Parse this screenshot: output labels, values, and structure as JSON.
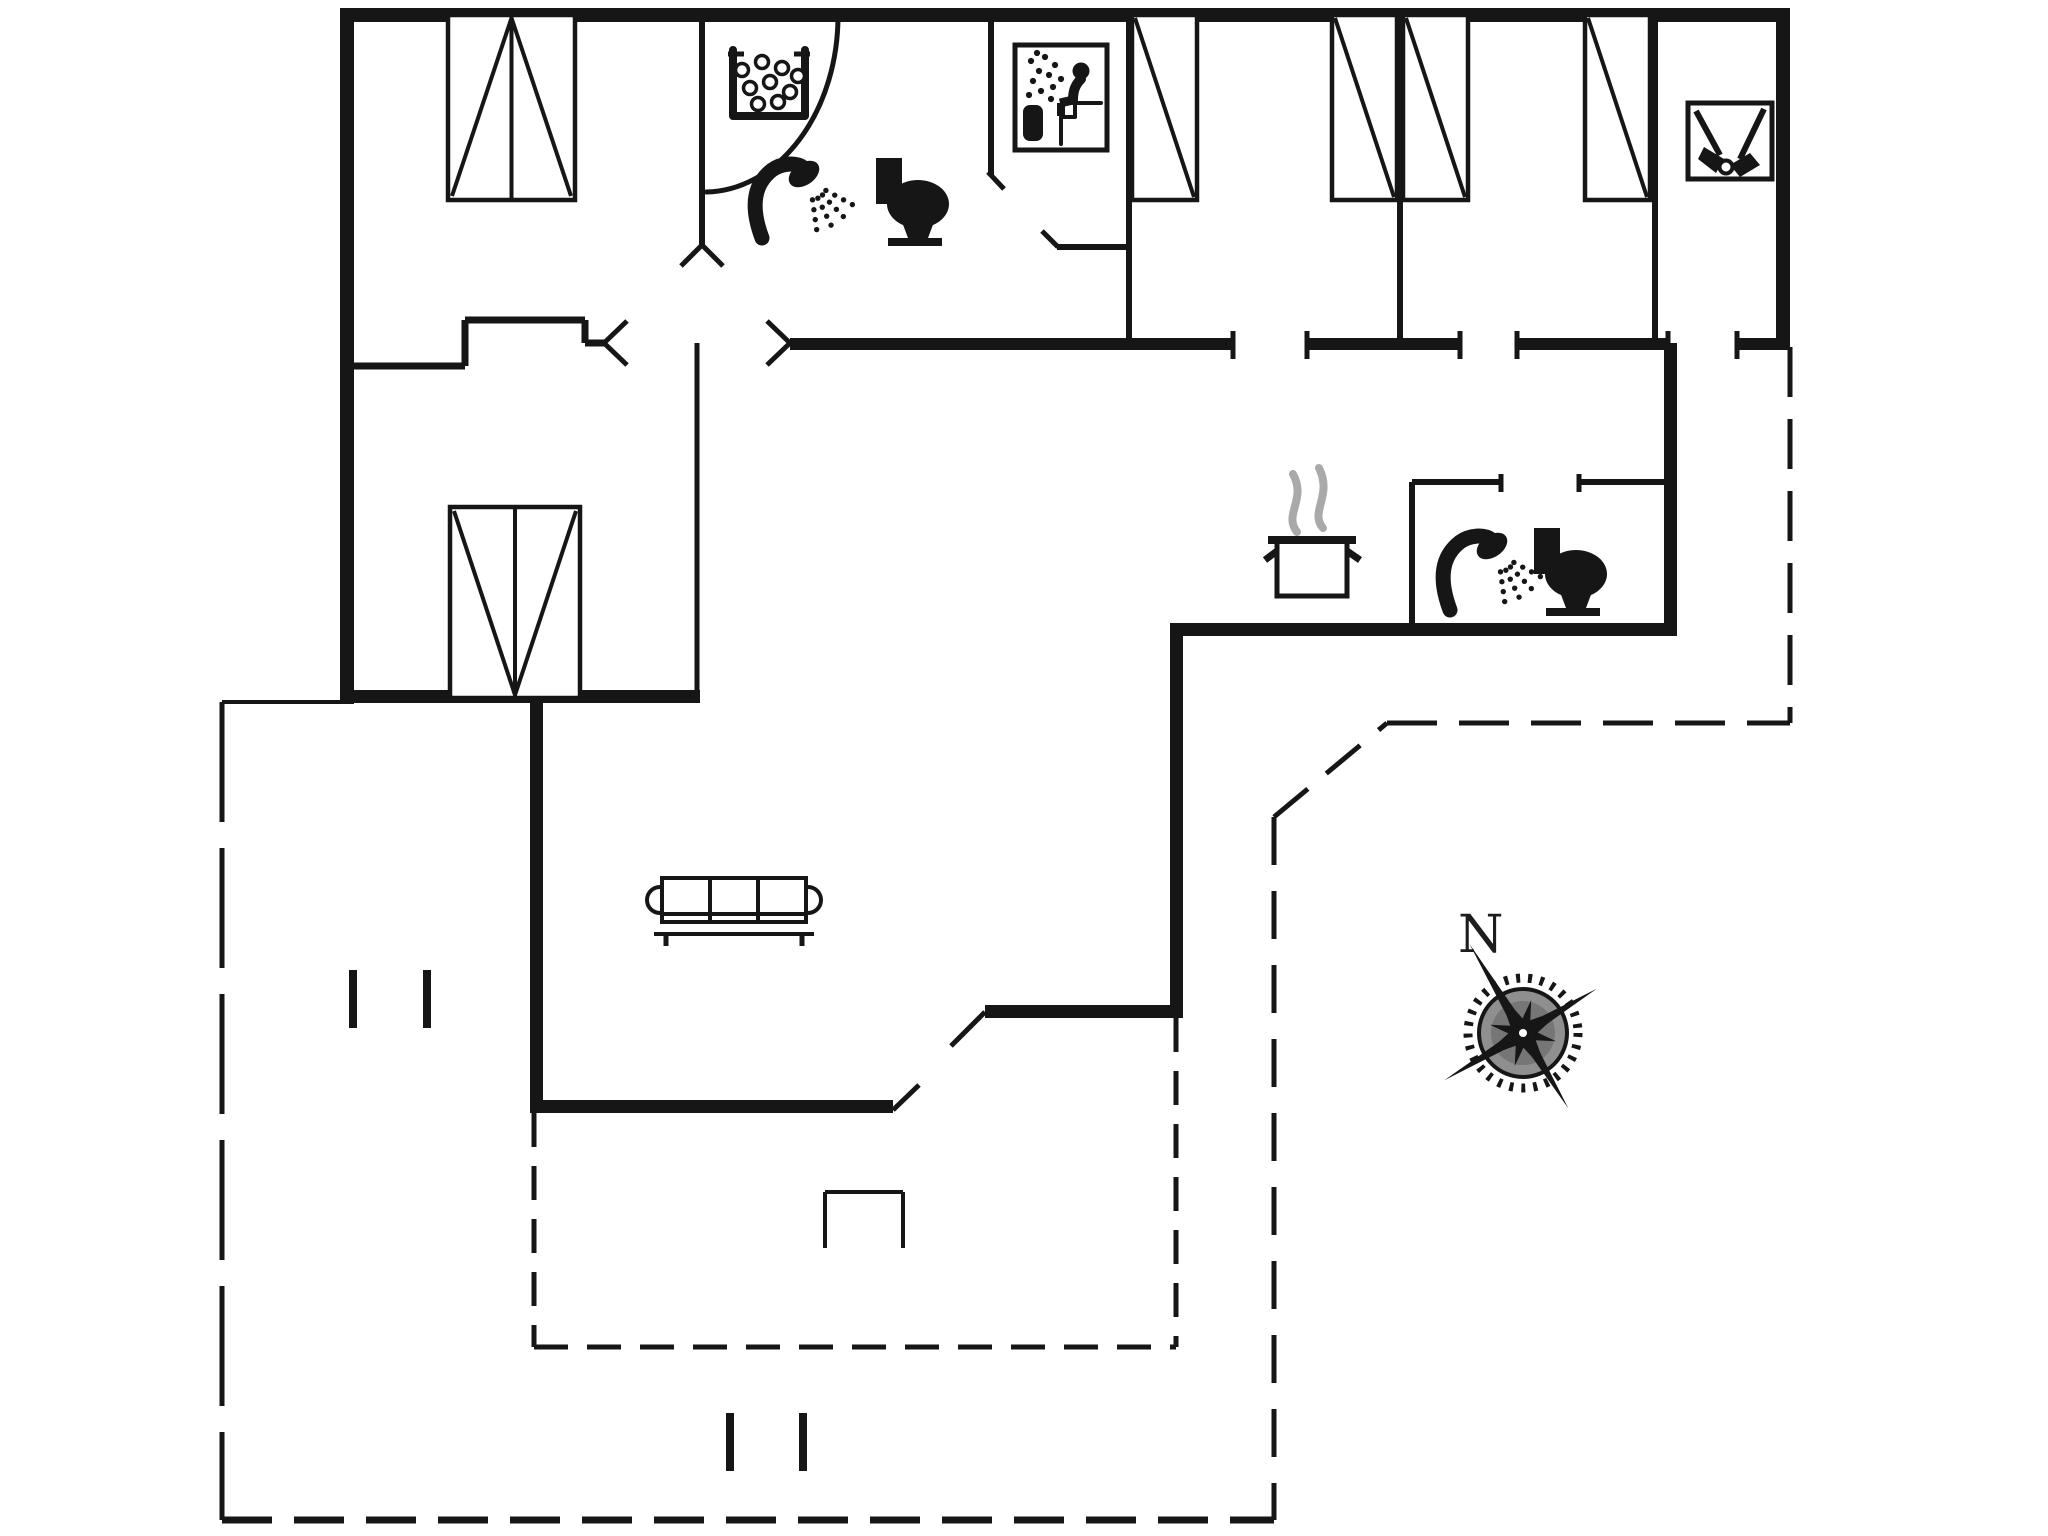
{
  "meta": {
    "type": "floorplan",
    "bg_color": "#ffffff",
    "ink_color": "#161616",
    "steam_color": "#a9a9a9",
    "compass_disc_color": "#8f8f8f",
    "compass_inner_color": "#767676"
  },
  "compass": {
    "label": "N",
    "cx": 1523,
    "cy": 1033,
    "gear_r": 55,
    "disc_r": 44,
    "inner_r": 32,
    "rot": -31,
    "spike_len": [
      104,
      86,
      88,
      92
    ],
    "star_len": 42,
    "diag_star_len": 34,
    "label_x": 1458,
    "label_y": 952
  },
  "walls_thick": [
    [
      340,
      8,
      1450,
      14,
      "exterior-wall-north"
    ],
    [
      340,
      8,
      14,
      696,
      "exterior-wall-west"
    ],
    [
      1776,
      8,
      14,
      342,
      "exterior-wall-east"
    ],
    [
      340,
      690,
      360,
      13,
      "alcove-south-wall"
    ],
    [
      530,
      701,
      13,
      412,
      "living-room-west-wall"
    ],
    [
      530,
      1100,
      363,
      13,
      "living-room-south-wall"
    ],
    [
      985,
      1005,
      198,
      13,
      "kitchen-south-wall"
    ],
    [
      1170,
      628,
      13,
      390,
      "kitchen-east-wall"
    ],
    [
      1170,
      623,
      507,
      13,
      "kitchen-bathroom-south-wall"
    ],
    [
      1664,
      343,
      13,
      293,
      "bathroom2-east-wall"
    ],
    [
      790,
      338,
      443,
      12,
      "corridor-wall-segment"
    ],
    [
      1307,
      338,
      153,
      12,
      "corridor-wall-segment"
    ],
    [
      1517,
      338,
      151,
      12,
      "corridor-wall-segment"
    ],
    [
      1737,
      338,
      53,
      12,
      "corridor-wall-segment"
    ]
  ],
  "walls_thin": [
    [
      702,
      15,
      702,
      245,
      6,
      "bedroom1-bathroom-partition"
    ],
    [
      991,
      15,
      991,
      175,
      6,
      "sauna-west-wall"
    ],
    [
      1057,
      247,
      1129,
      247,
      6,
      "sauna-south-wall"
    ],
    [
      1129,
      15,
      1129,
      343,
      6,
      "sauna-east-wall"
    ],
    [
      1400,
      15,
      1400,
      343,
      6,
      "bedroom-partition-wall"
    ],
    [
      1655,
      15,
      1655,
      343,
      6,
      "utility-partition-wall"
    ],
    [
      348,
      366,
      465,
      366,
      7,
      "entry-niche-wall"
    ],
    [
      465,
      320,
      465,
      366,
      7,
      "entry-niche-wall"
    ],
    [
      465,
      320,
      585,
      320,
      7,
      "entry-niche-wall"
    ],
    [
      585,
      320,
      585,
      343,
      7,
      "entry-niche-wall"
    ],
    [
      585,
      343,
      604,
      343,
      7,
      "entry-niche-wall"
    ],
    [
      697,
      343,
      697,
      690,
      5,
      "alcove-east-wall"
    ],
    [
      1412,
      482,
      1412,
      628,
      6,
      "bathroom2-west-wall"
    ],
    [
      1412,
      482,
      1501,
      482,
      6,
      "bathroom2-north-wall"
    ],
    [
      1579,
      482,
      1667,
      482,
      6,
      "bathroom2-north-wall"
    ],
    [
      222,
      702,
      340,
      702,
      4,
      "terrace-edge-line"
    ],
    [
      825,
      1192,
      903,
      1192,
      4,
      "terrace-step-line"
    ],
    [
      825,
      1192,
      825,
      1248,
      4,
      "terrace-step-line"
    ],
    [
      903,
      1192,
      903,
      1248,
      4,
      "terrace-step-line"
    ]
  ],
  "dashed_lines": [
    [
      222,
      702,
      222,
      1520,
      5,
      [
        120,
        26
      ],
      "boundary-dashed-west"
    ],
    [
      222,
      1520,
      1274,
      1520,
      7,
      [
        50,
        22
      ],
      "boundary-dashed-south"
    ],
    [
      1274,
      817,
      1274,
      1520,
      5,
      [
        48,
        26
      ],
      "boundary-dashed-east-inner"
    ],
    [
      1274,
      817,
      1387,
      723,
      5,
      [
        44,
        24
      ],
      "boundary-dashed-diagonal"
    ],
    [
      1387,
      723,
      1790,
      723,
      5,
      [
        50,
        22
      ],
      "boundary-dashed-mid"
    ],
    [
      1790,
      347,
      1790,
      723,
      5,
      [
        50,
        22
      ],
      "boundary-dashed-far-east"
    ],
    [
      534,
      1113,
      534,
      1347,
      5,
      [
        34,
        19
      ],
      "terrace-dashed-west"
    ],
    [
      534,
      1347,
      1176,
      1347,
      5,
      [
        34,
        19
      ],
      "terrace-dashed-south"
    ],
    [
      1176,
      1018,
      1176,
      1347,
      5,
      [
        34,
        19
      ],
      "terrace-dashed-east"
    ]
  ],
  "door_arcs": [
    {
      "d": "M 838 16 A 134 176 0 0 1 706 192",
      "w": 5,
      "name": "bathroom1-door-arc"
    }
  ],
  "door_marks": [
    [
      702,
      245,
      681,
      266,
      "door-jamb-mark"
    ],
    [
      702,
      245,
      723,
      266,
      "door-jamb-mark"
    ],
    [
      604,
      343,
      627,
      321,
      "door-jamb-mark"
    ],
    [
      604,
      343,
      627,
      365,
      "door-jamb-mark"
    ],
    [
      790,
      343,
      767,
      321,
      "door-jamb-mark"
    ],
    [
      790,
      343,
      767,
      365,
      "door-jamb-mark"
    ],
    [
      988,
      172,
      1004,
      189,
      "sauna-door-mark"
    ],
    [
      1042,
      231,
      1058,
      247,
      "sauna-door-mark"
    ],
    [
      893,
      1110,
      919,
      1085,
      "terrace-door-jamb-mark"
    ],
    [
      985,
      1012,
      951,
      1046,
      "terrace-door-leaf"
    ]
  ],
  "jamb_ticks": [
    [
      1233,
      331,
      1233,
      359
    ],
    [
      1307,
      331,
      1307,
      359
    ],
    [
      1460,
      331,
      1460,
      359
    ],
    [
      1517,
      331,
      1517,
      359
    ],
    [
      1668,
      331,
      1668,
      359
    ],
    [
      1737,
      331,
      1737,
      359
    ],
    [
      1501,
      474,
      1501,
      492
    ],
    [
      1579,
      474,
      1579,
      492
    ]
  ],
  "terrace_ticks": [
    [
      353,
      970,
      353,
      1028
    ],
    [
      427,
      970,
      427,
      1028
    ],
    [
      730,
      1413,
      730,
      1471
    ],
    [
      803,
      1413,
      803,
      1471
    ]
  ],
  "beds": [
    {
      "type": "double",
      "x": 448,
      "y": 15,
      "w": 127,
      "h": 185,
      "head": "top",
      "name": "double-bed"
    },
    {
      "type": "double",
      "x": 450,
      "y": 507,
      "w": 130,
      "h": 191,
      "head": "bottom",
      "name": "double-bed"
    },
    {
      "type": "single",
      "x": 1132,
      "y": 15,
      "w": 65,
      "h": 185,
      "name": "single-bed"
    },
    {
      "type": "single",
      "x": 1332,
      "y": 15,
      "w": 65,
      "h": 185,
      "name": "single-bed"
    },
    {
      "type": "single",
      "x": 1403,
      "y": 15,
      "w": 65,
      "h": 185,
      "name": "single-bed"
    },
    {
      "type": "single",
      "x": 1585,
      "y": 15,
      "w": 65,
      "h": 185,
      "name": "single-bed"
    }
  ],
  "icons": [
    {
      "kind": "jacuzzi",
      "name": "whirlpool-bath-icon",
      "x": 728,
      "y": 50,
      "w": 82,
      "h": 72
    },
    {
      "kind": "shower",
      "name": "shower-icon",
      "x": 752,
      "y": 158,
      "w": 92,
      "h": 92
    },
    {
      "kind": "toilet",
      "name": "toilet-icon",
      "x": 876,
      "y": 158,
      "w": 74,
      "h": 88
    },
    {
      "kind": "sauna",
      "name": "sauna-icon",
      "x": 1015,
      "y": 45,
      "w": 92,
      "h": 105
    },
    {
      "kind": "cleaning",
      "name": "cleaning-equipment-icon",
      "x": 1688,
      "y": 103,
      "w": 84,
      "h": 76
    },
    {
      "kind": "pot",
      "name": "cooking-pot-icon",
      "x": 1263,
      "y": 462,
      "w": 100,
      "h": 134
    },
    {
      "kind": "shower",
      "name": "shower-icon",
      "x": 1440,
      "y": 530,
      "w": 84,
      "h": 88
    },
    {
      "kind": "toilet",
      "name": "toilet-icon",
      "x": 1534,
      "y": 528,
      "w": 74,
      "h": 88
    },
    {
      "kind": "sofa",
      "name": "sofa-icon",
      "x": 646,
      "y": 874,
      "w": 176,
      "h": 72
    }
  ]
}
